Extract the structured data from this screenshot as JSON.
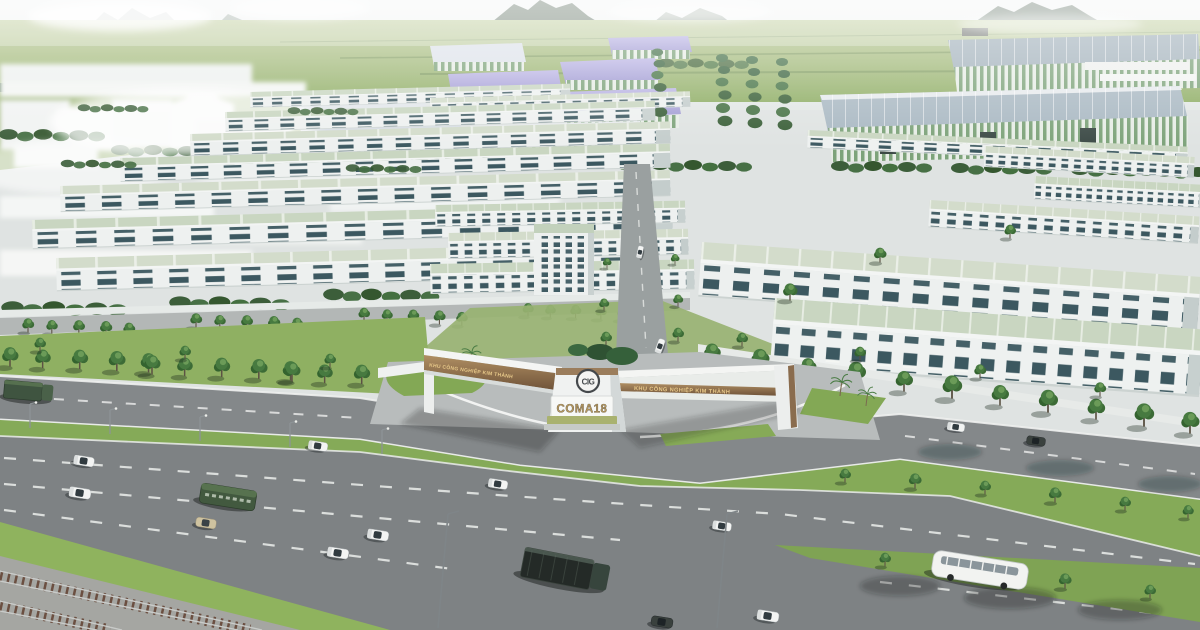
{
  "scene": {
    "alt_text": "Aerial 3D architectural rendering: rows of white townhouses with pale green roofs, an industrial park with purple-roofed warehouses, tree-lined boulevards, a multi-lane highway with cars, buses and trucks, a railway line, distant green mountains, and a V-shaped entrance gate bearing a circular CIG logo and a COMA18 sign.",
    "gate": {
      "logo_monogram": "CIG",
      "pylon_sign": "COMA18",
      "left_wing_text": "KHU CÔNG NGHIỆP KIM THÀNH",
      "right_wing_text": "KHU CÔNG NGHIỆP KIM THÀNH"
    },
    "colors": {
      "sky": "#eef1f1",
      "mountain": "#66786a",
      "field": "#9fb878",
      "purple_roof": "#aba5d8",
      "green_roof": "#c9d6c1",
      "facade_white": "#eef1f0",
      "window_teal": "#2d4b54",
      "tree_green": "#3f6f3c",
      "grass": "#85aa58",
      "asphalt": "#7e8284",
      "lane_marking": "#e9ebe9",
      "bronze_band": "#8a6a4c",
      "gold_lettering": "#e8c98a",
      "sign_lettering": "#b99a5e",
      "rail_ballast": "#a5a6a2"
    }
  }
}
